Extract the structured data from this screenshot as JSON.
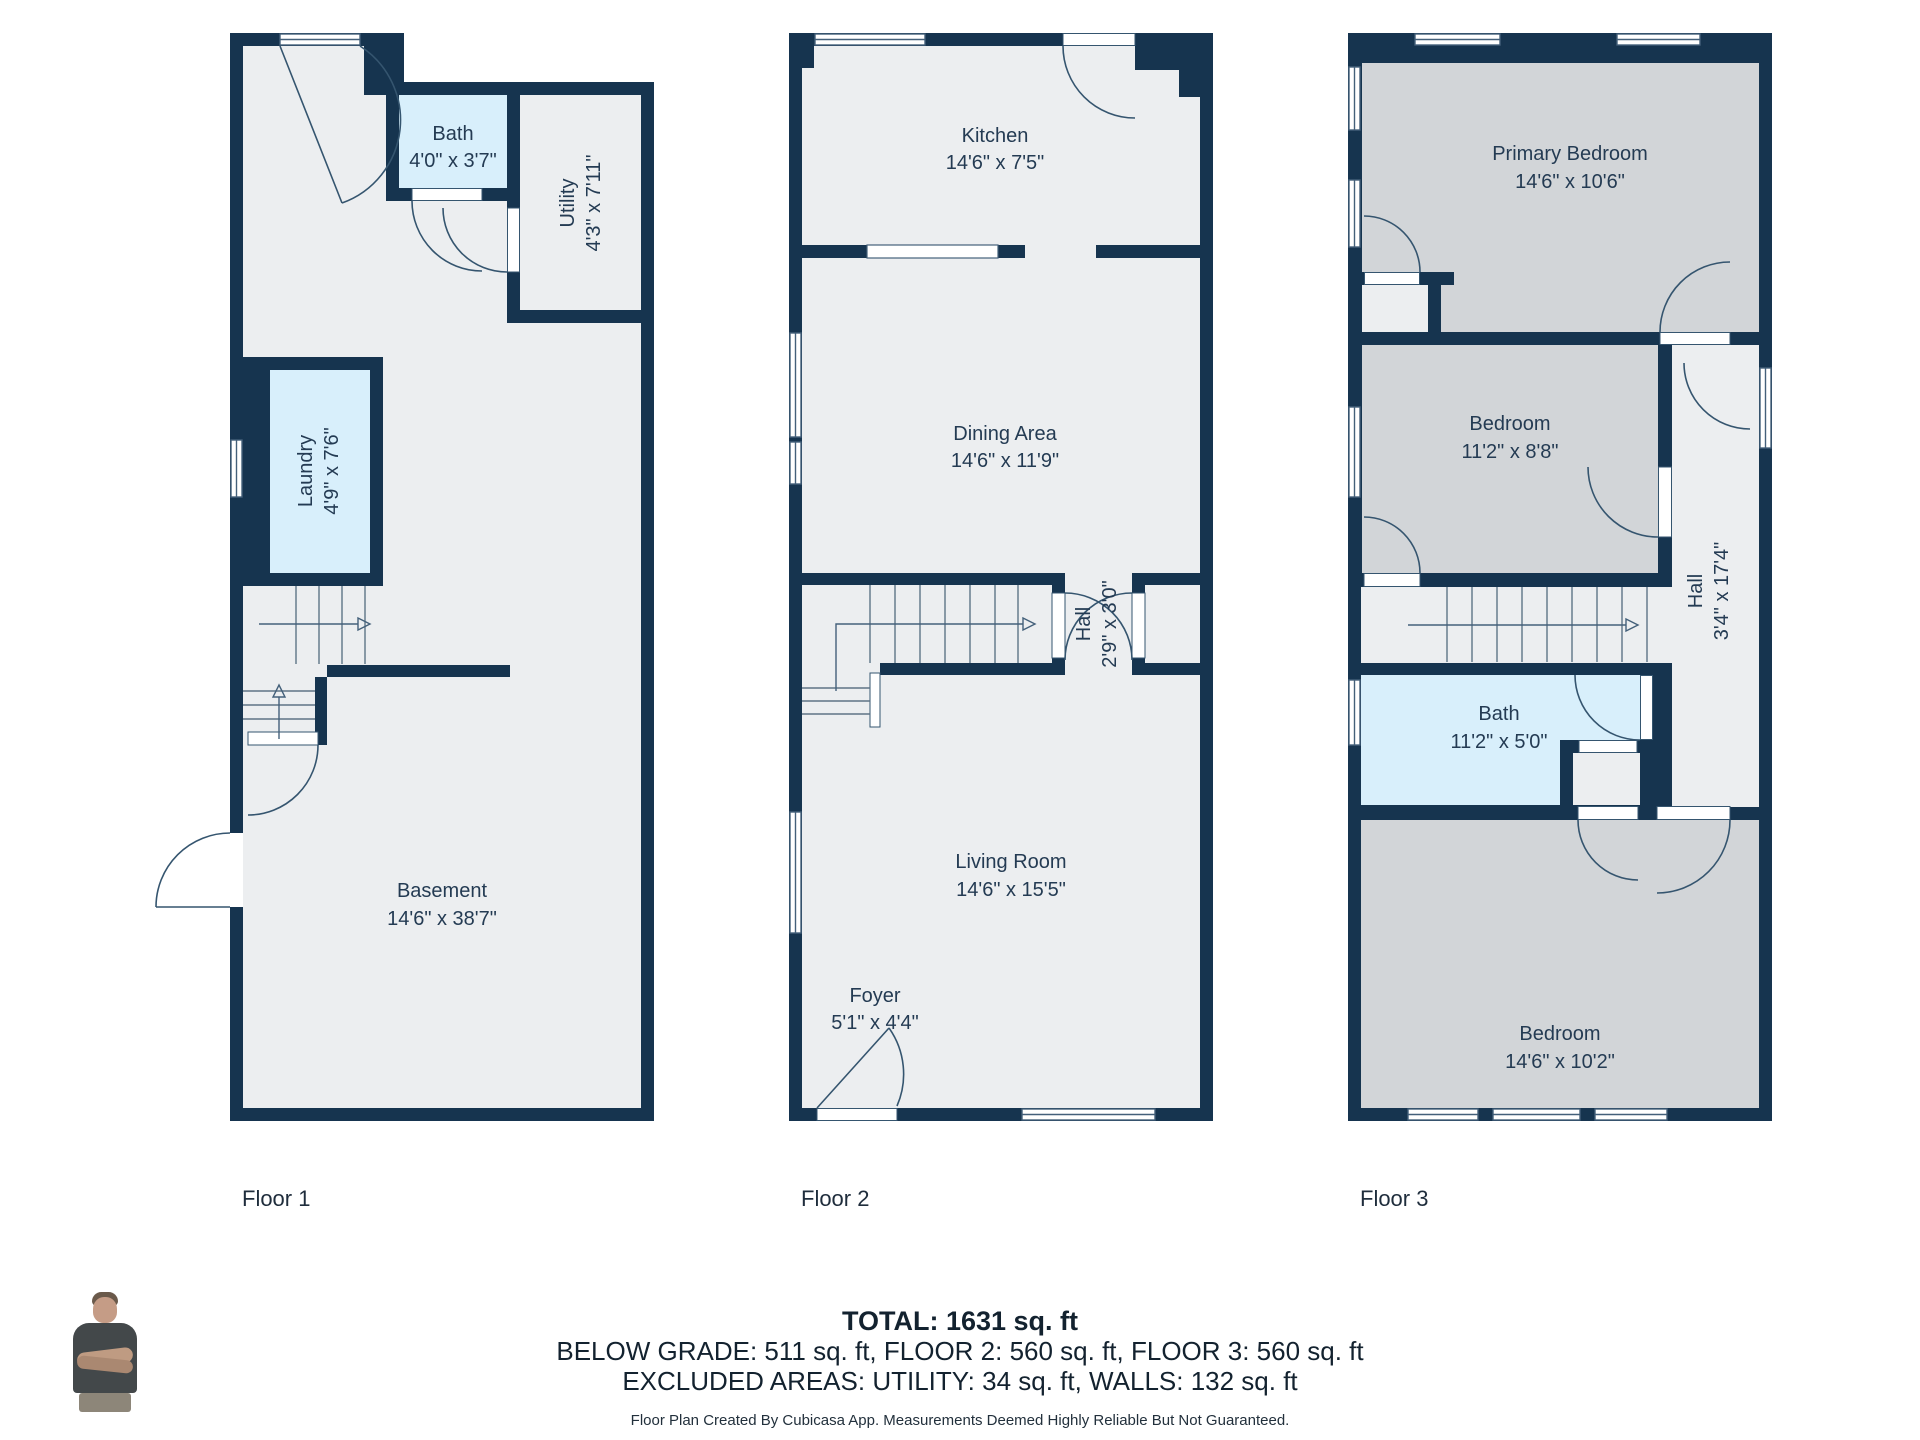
{
  "colors": {
    "wall": "#16344F",
    "floor": "#ECEEF0",
    "bedroom_fill": "#D2D5D8",
    "wet_room_fill": "#D8EFFB",
    "label_text": "#243B53",
    "summary_text": "#13222f"
  },
  "floors": [
    {
      "label": "Floor 1",
      "rooms": [
        {
          "name": "Bath",
          "dims": "4'0\" x 3'7\""
        },
        {
          "name": "Utility",
          "dims": "4'3\" x 7'11\""
        },
        {
          "name": "Laundry",
          "dims": "4'9\" x 7'6\""
        },
        {
          "name": "Basement",
          "dims": "14'6\" x 38'7\""
        }
      ]
    },
    {
      "label": "Floor 2",
      "rooms": [
        {
          "name": "Kitchen",
          "dims": "14'6\" x 7'5\""
        },
        {
          "name": "Dining Area",
          "dims": "14'6\" x 11'9\""
        },
        {
          "name": "Hall",
          "dims": "2'9\" x 3'0\""
        },
        {
          "name": "Living Room",
          "dims": "14'6\" x 15'5\""
        },
        {
          "name": "Foyer",
          "dims": "5'1\" x 4'4\""
        }
      ]
    },
    {
      "label": "Floor 3",
      "rooms": [
        {
          "name": "Primary Bedroom",
          "dims": "14'6\" x 10'6\""
        },
        {
          "name": "Bedroom",
          "dims": "11'2\" x 8'8\""
        },
        {
          "name": "Hall",
          "dims": "3'4\" x 17'4\""
        },
        {
          "name": "Bath",
          "dims": "11'2\" x 5'0\""
        },
        {
          "name": "Bedroom",
          "dims": "14'6\" x 10'2\""
        }
      ]
    }
  ],
  "summary": {
    "total": "TOTAL: 1631 sq. ft",
    "by_floor": "BELOW GRADE: 511 sq. ft, FLOOR 2: 560 sq. ft, FLOOR 3: 560 sq. ft",
    "excluded": "EXCLUDED AREAS: UTILITY: 34 sq. ft, WALLS: 132 sq. ft",
    "disclaimer": "Floor Plan Created By Cubicasa App. Measurements Deemed Highly Reliable But Not Guaranteed."
  }
}
